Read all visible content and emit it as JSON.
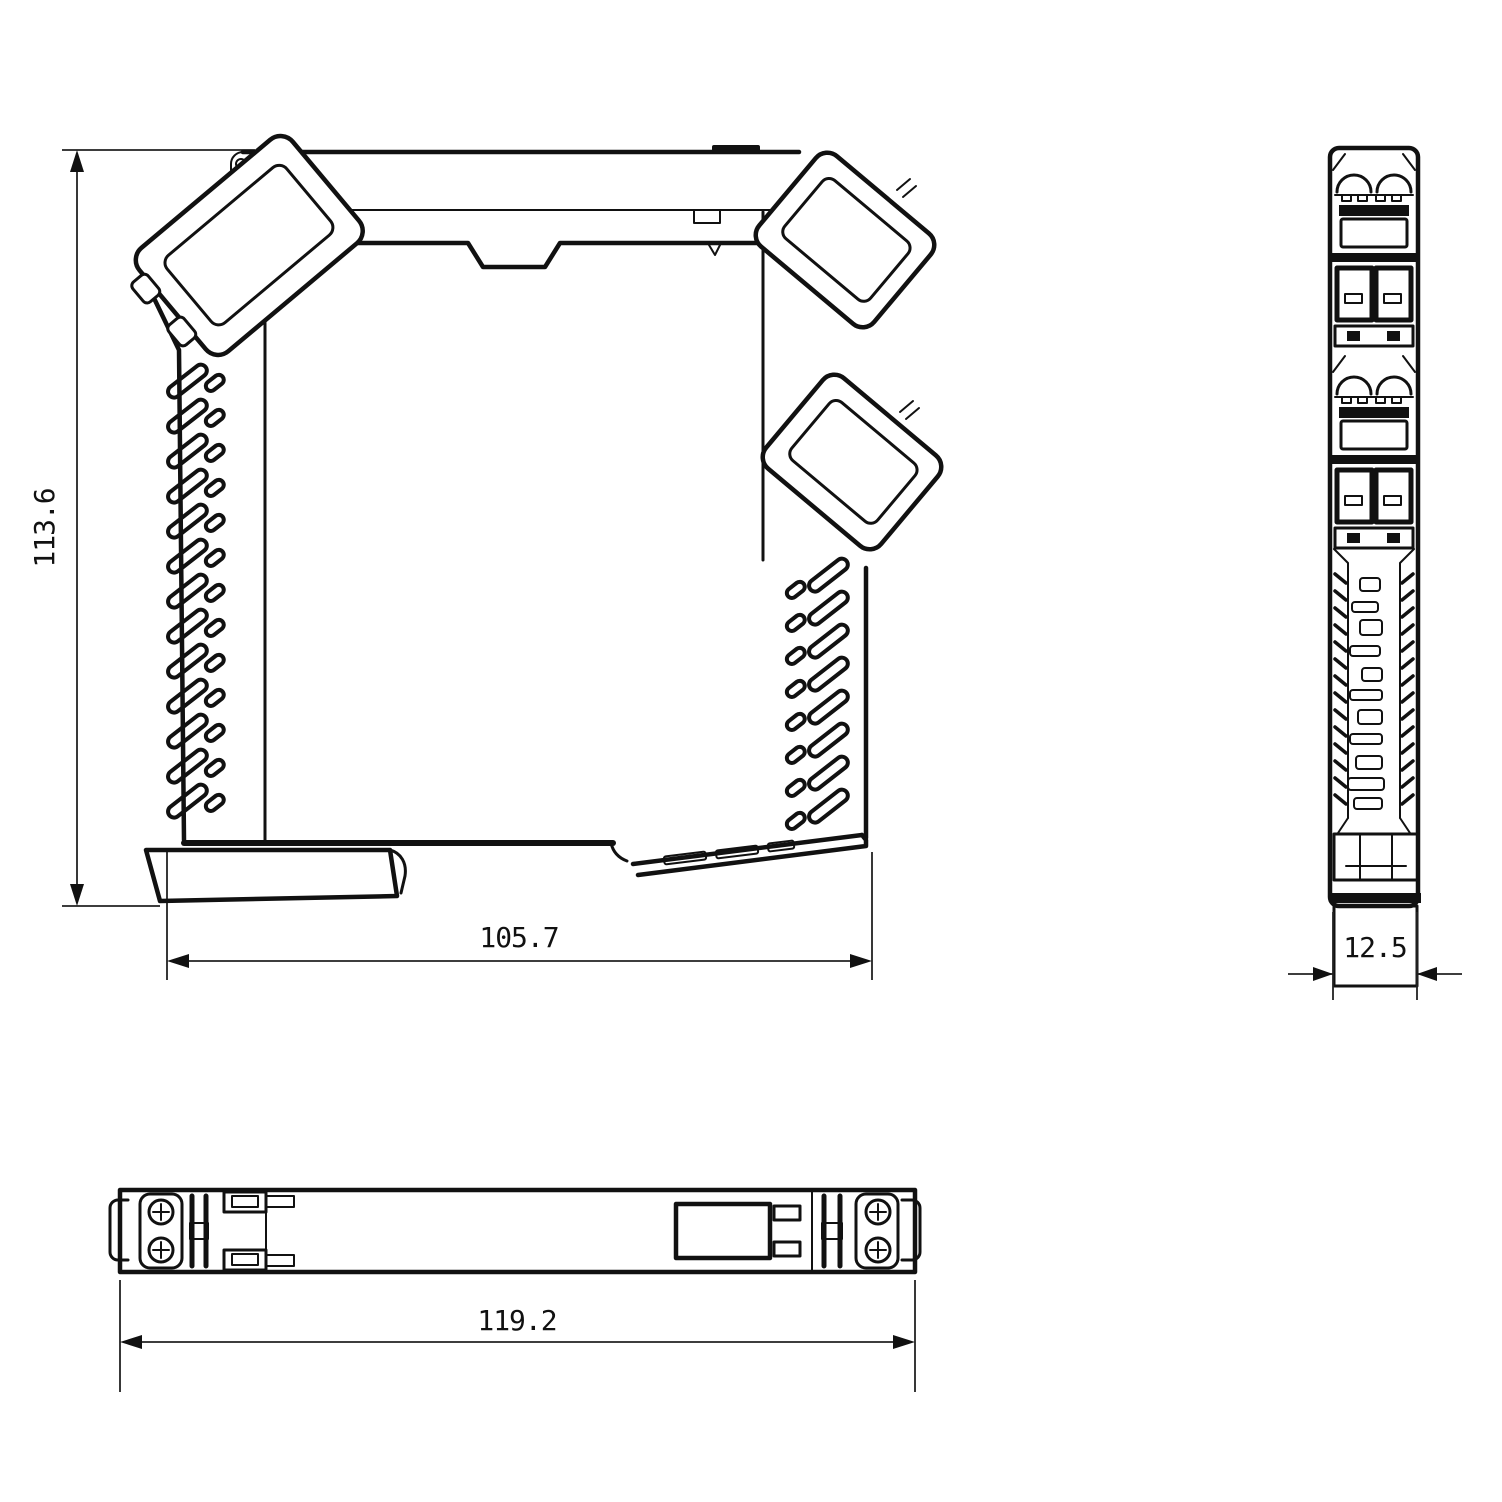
{
  "dimensions": {
    "front_height": "113.6",
    "front_width": "105.7",
    "side_depth": "12.5",
    "bottom_length": "119.2"
  },
  "colors": {
    "line": "#111111",
    "background": "#ffffff"
  }
}
